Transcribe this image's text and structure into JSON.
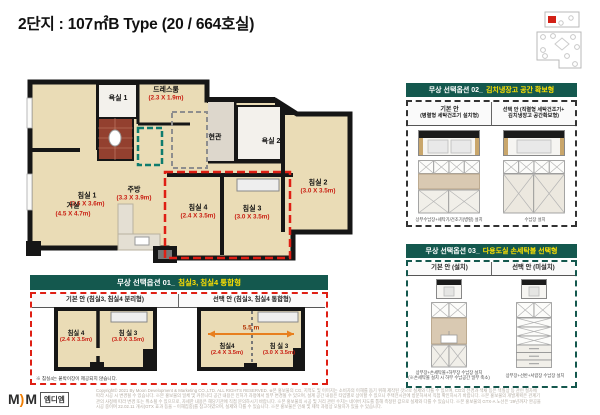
{
  "title": "2단지 : 107㎡B Type (20 / 664호실)",
  "plan": {
    "bed1": {
      "name": "침실 1",
      "dims": "(3.6 X 3.6m)"
    },
    "bath1": {
      "name": "욕실 1"
    },
    "dress": {
      "name": "드레스룸",
      "dims": "(2.3 X 1.9m)"
    },
    "entry": {
      "name": "현관"
    },
    "bath2": {
      "name": "욕실 2"
    },
    "bed2": {
      "name": "침실 2",
      "dims": "(3.0 X 3.5m)"
    },
    "living": {
      "name": "거실",
      "dims": "(4.5 X 4.7m)"
    },
    "kitchen": {
      "name": "주방",
      "dims": "(3.3 X 3.9m)"
    },
    "bed4": {
      "name": "침실 4",
      "dims": "(2.4 X 3.5m)"
    },
    "bed3": {
      "name": "침실 3",
      "dims": "(3.0 X 3.5m)"
    }
  },
  "option1": {
    "title_prefix": "무상 선택옵션 01_",
    "title_highlight": "침실3, 침실4 통합형",
    "basic_header": "기본 안 (침실3, 침실4 분리형)",
    "select_header": "선택 안 (침실3, 침실4 통합형)",
    "bed4_name": "침실 4",
    "bed4_dims": "(2.4 X 3.5m)",
    "bed3_name": "침 실 3",
    "bed3_dims": "(3.0 X 3.5m)",
    "sel_bed4_name": "침실4",
    "sel_bed4_dims": "(2.4 X 3.5m)",
    "sel_bed3_name": "침 실 3",
    "sel_bed3_dims": "(3.0 X 3.5m)",
    "arrow_label": "5.5 m",
    "note": "※ 침실4는 붙박이장이 제공되지 않습니다."
  },
  "option2": {
    "title_prefix": "무상 선택옵션 02_",
    "title_highlight": "김치냉장고 공간 확보형",
    "basic_header_line1": "기본 안",
    "basic_header_line2": "(병렬형 세탁건조기 설치형)",
    "select_header_line1": "선택 안 (직렬형 세탁건조기+",
    "select_header_line2": "김치냉장고 공간확보형)",
    "basic_caption": "상부수납장+세탁기/건조기(병렬) 설치",
    "select_caption": "수납장 설치"
  },
  "option3": {
    "title_prefix": "무상 선택옵션 03_",
    "title_highlight": "다용도실 손세탁볼 선택형",
    "basic_header": "기본 안 (설치)",
    "select_header": "선택 안 (미설치)",
    "basic_caption_line1": "상부장+손세탁볼+하부장 수납장 설치",
    "basic_caption_line2": "(※손세탁볼 설치 시 하부 수납공간 일부 축소)",
    "select_caption": "상부장+선반+서랍장 수납장 설치"
  },
  "footer": {
    "logo_m1": "M",
    "logo_m2": "M",
    "logo_text": "엠디엠",
    "lines": [
      "Copyright© 2021 By Moon Development & Marketing CO.,LTD. ALL RIGHTS RESERVED. ※본 홍보물의 CG, 지적도 및 이미지는 소비자의 이해를 돕기 위해 제작된 것으로 실제와 다를 수 있으며, CG의 전경과 색채 등은 색칠상 등 관련 절차에",
      "따라 시공 시 변경될 수 있습니다. ※본 홍보물의 일체 및 커뮤니티 공간 내용은 인허가 과정에서 일부 변경될 수 있으며, 설계 공간 내용은 타입별로 상이할 수 있으니 주택전시관에 방문하셔서 직접 확인하시기 바랍니다. ※본 홍보물의 개발계획은 관계기",
      "관의 사정에 따라 변경 또는 취소될 수 있으므로, 자세한 내용은 해당기관에 직접 문의하시기 바랍니다. ※본 홍보물의 시공 및 거리 관련 수치는 네이버 지도를 통해 측정된 값으로 실제와 다를 수 있습니다. ※본 홍보물의 GTX-A 노선은 '29년까지' 완공을",
      "시공 중이며 22.02.11 개시(GTX 효과 등을 – 이해집중)를 참고하였으며, 실제와 다를 수 있습니다. ※본 홍보물은 인쇄 및 제작 과정상 오탈자가 있을 수 있습니다."
    ]
  },
  "colors": {
    "teal": "#14584e",
    "yellow": "#ffe100",
    "red": "#df1f14",
    "orange_arrow": "#e87f1e"
  }
}
